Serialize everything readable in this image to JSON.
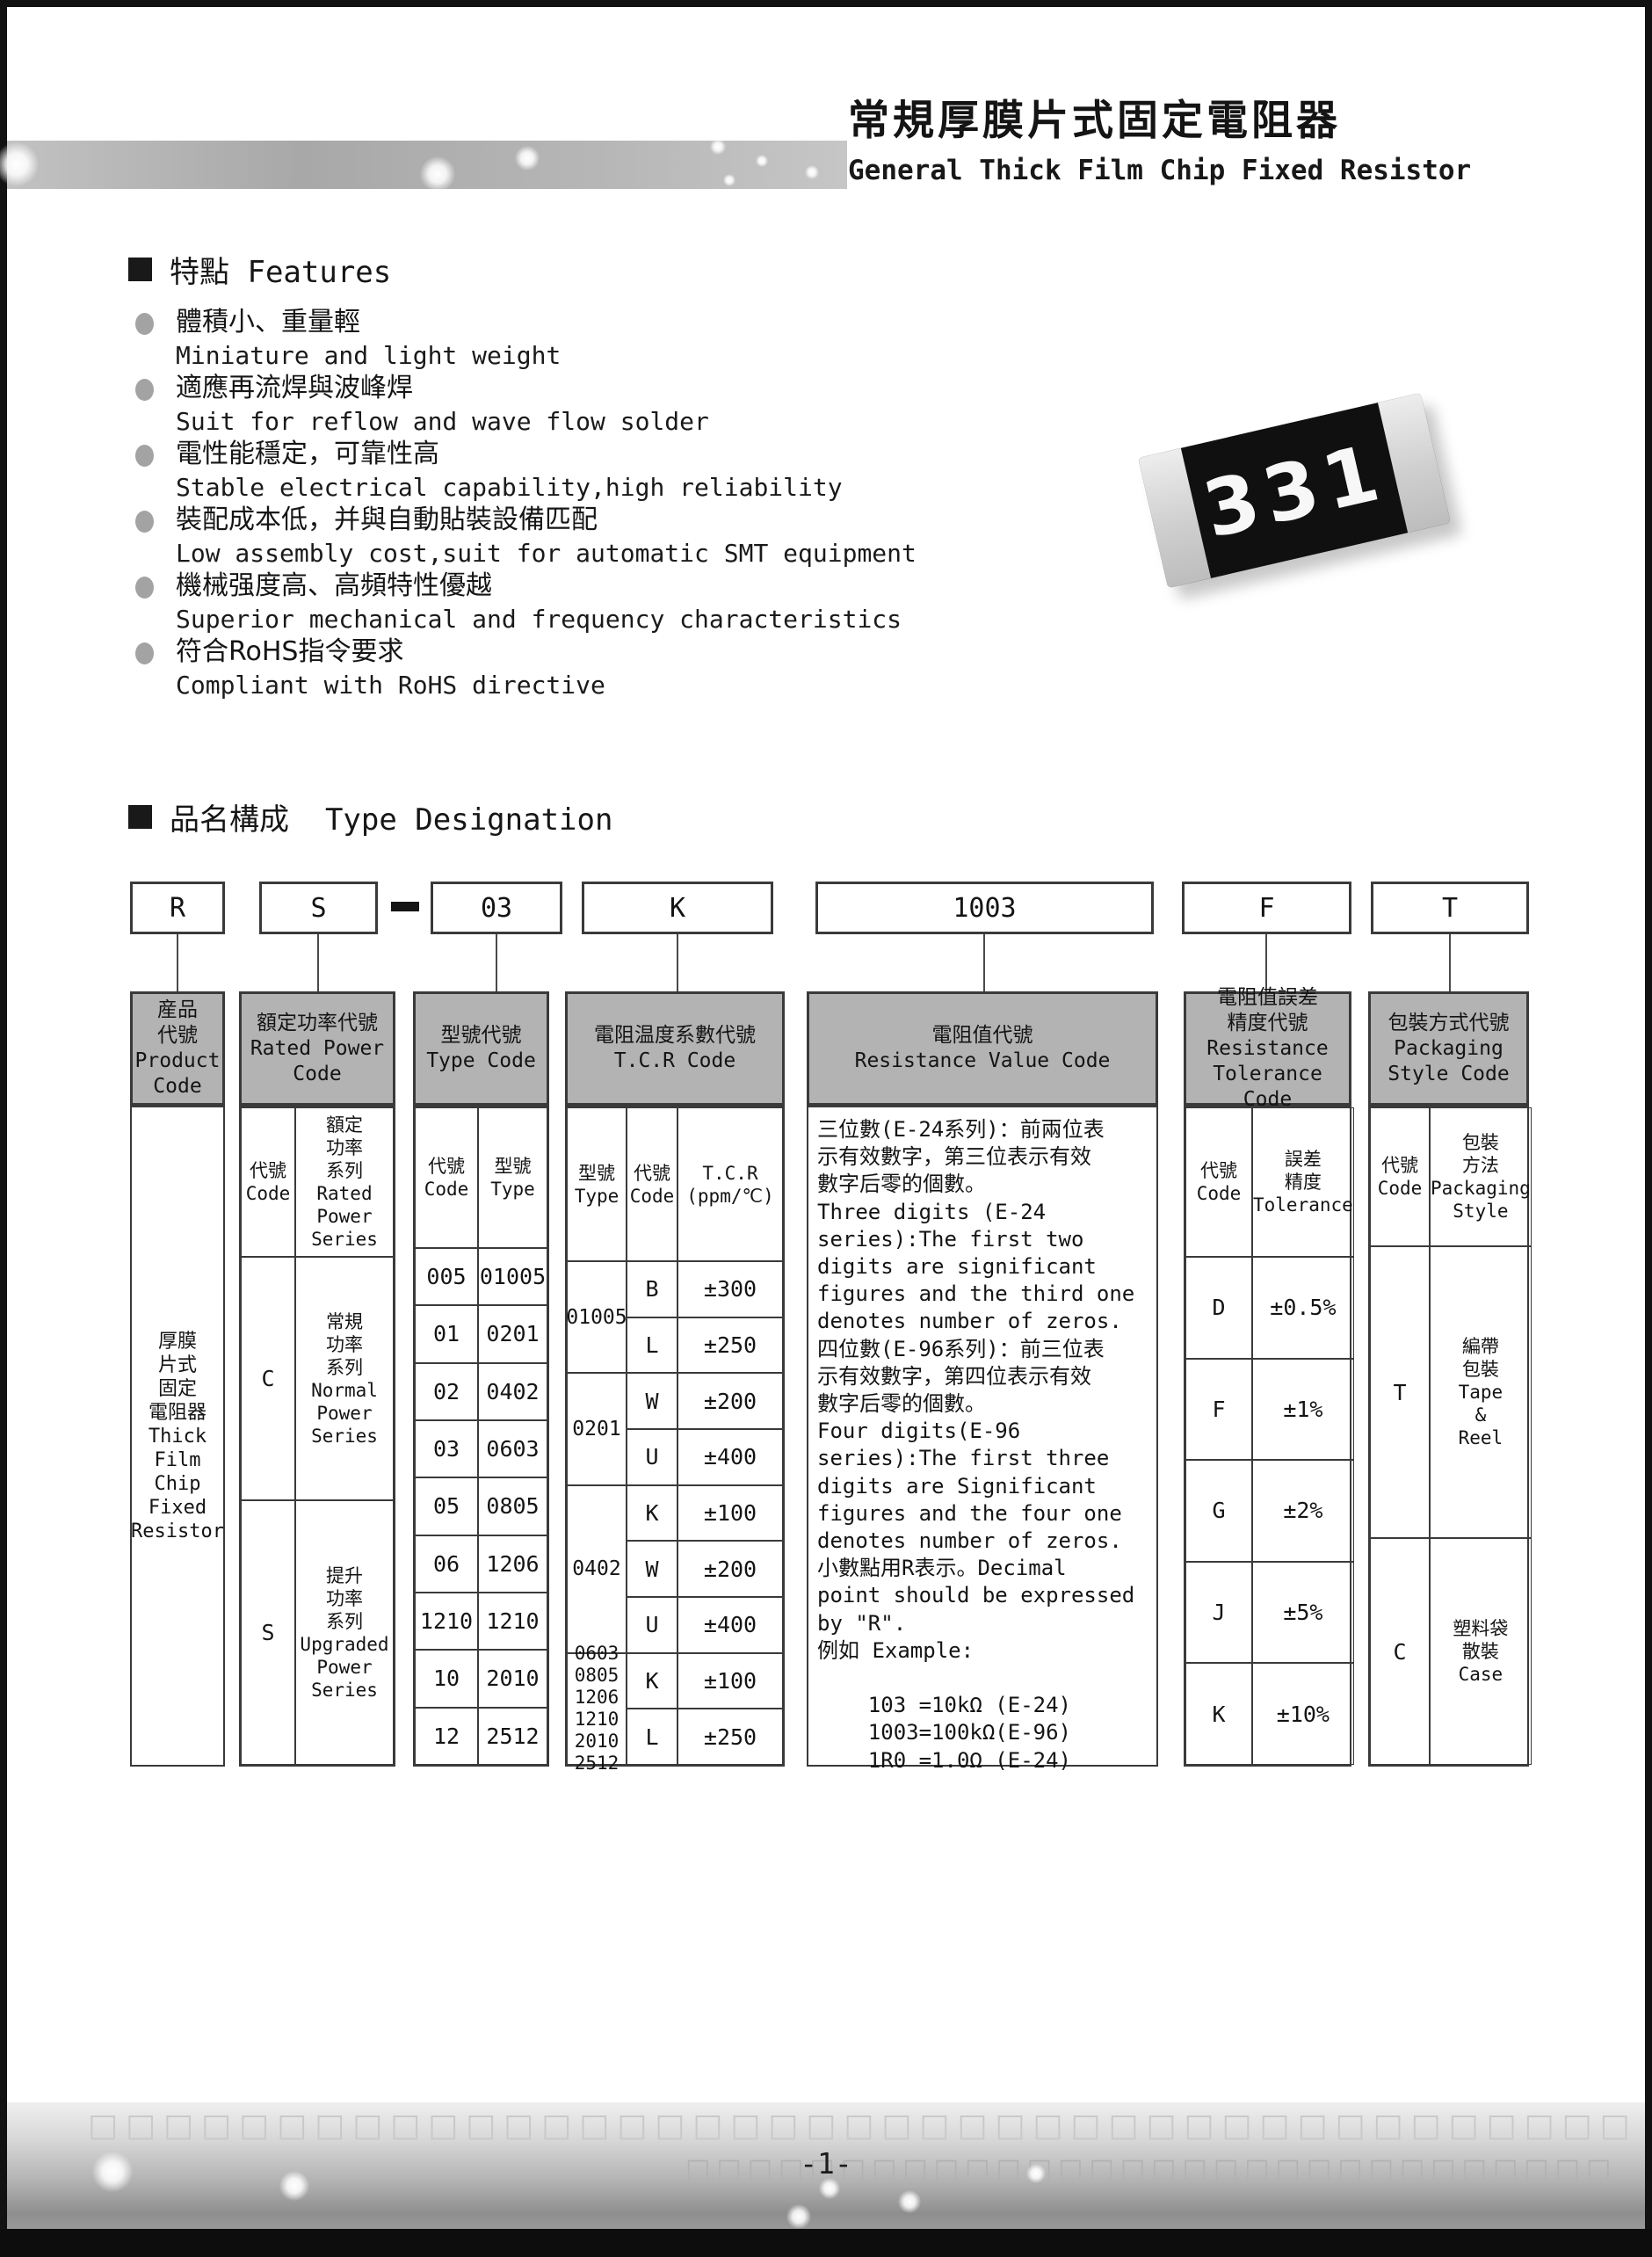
{
  "header": {
    "title_zh": "常規厚膜片式固定電阻器",
    "title_en": "General Thick Film Chip Fixed Resistor"
  },
  "chip": {
    "marking": "331"
  },
  "features": {
    "heading": "特點 Features",
    "items": [
      {
        "zh": "體積小、重量輕",
        "en": "Miniature and light weight"
      },
      {
        "zh": "適應再流焊與波峰焊",
        "en": "Suit for reflow and wave flow solder"
      },
      {
        "zh": "電性能穩定，可靠性高",
        "en": "Stable electrical capability,high reliability"
      },
      {
        "zh": "裝配成本低，并與自動貼裝設備匹配",
        "en": "Low assembly cost,suit for automatic SMT equipment"
      },
      {
        "zh": "機械强度高、高頻特性優越",
        "en": "Superior mechanical and frequency characteristics"
      },
      {
        "zh": "符合RoHS指令要求",
        "en": "Compliant with RoHS directive"
      }
    ]
  },
  "designation": {
    "heading": "品名構成  Type Designation",
    "codes": [
      "R",
      "S",
      "03",
      "K",
      "1003",
      "F",
      "T"
    ]
  },
  "table": {
    "product": {
      "header": "産品\n代號\nProduct\nCode",
      "body": "厚膜\n片式\n固定\n電阻器\nThick\nFilm\nChip\nFixed\nResistor"
    },
    "power": {
      "header": "額定功率代號\nRated Power\nCode",
      "sub_code": "代號\nCode",
      "sub_series": "額定\n功率\n系列\nRated\nPower\nSeries",
      "rows": [
        {
          "code": "C",
          "series": "常規\n功率\n系列\nNormal\nPower\nSeries"
        },
        {
          "code": "S",
          "series": "提升\n功率\n系列\nUpgraded\nPower\nSeries"
        }
      ]
    },
    "type": {
      "header": "型號代號\nType Code",
      "sub_code": "代號\nCode",
      "sub_type": "型號\nType",
      "rows": [
        [
          "005",
          "01005"
        ],
        [
          "01",
          "0201"
        ],
        [
          "02",
          "0402"
        ],
        [
          "03",
          "0603"
        ],
        [
          "05",
          "0805"
        ],
        [
          "06",
          "1206"
        ],
        [
          "1210",
          "1210"
        ],
        [
          "10",
          "2010"
        ],
        [
          "12",
          "2512"
        ]
      ]
    },
    "tcr": {
      "header": "電阻温度系數代號\nT.C.R Code",
      "sub_type": "型號\nType",
      "sub_code": "代號\nCode",
      "sub_val": "T.C.R\n(ppm/℃)",
      "types": [
        "01005",
        "0201",
        "0402",
        "0603\n0805\n1206\n1210\n2010\n2512"
      ],
      "rows": [
        [
          "B",
          "±300"
        ],
        [
          "L",
          "±250"
        ],
        [
          "W",
          "±200"
        ],
        [
          "U",
          "±400"
        ],
        [
          "K",
          "±100"
        ],
        [
          "W",
          "±200"
        ],
        [
          "U",
          "±400"
        ],
        [
          "K",
          "±100"
        ],
        [
          "L",
          "±250"
        ]
      ]
    },
    "resistance": {
      "header": "電阻值代號\nResistance Value Code",
      "body": "三位數(E-24系列)：前兩位表\n示有效數字，第三位表示有效\n數字后零的個數。\nThree digits (E-24\nseries):The first two\ndigits are significant\nfigures and the third one\ndenotes number of zeros.\n四位數(E-96系列)：前三位表\n示有效數字，第四位表示有效\n數字后零的個數。\nFour digits(E-96\nseries):The first three\ndigits are Significant\nfigures and the four one\ndenotes number of zeros.\n小數點用R表示。Decimal\npoint should be expressed\nby \"R\".\n例如 Example:\n\n    103 =10kΩ (E-24)\n    1003=100kΩ(E-96)\n    1R0 =1.0Ω (E-24)"
    },
    "tolerance": {
      "header": "電阻值誤差\n精度代號\nResistance\nTolerance Code",
      "sub_code": "代號\nCode",
      "sub_tol": "誤差\n精度\nTolerance",
      "rows": [
        [
          "D",
          "±0.5%"
        ],
        [
          "F",
          "±1%"
        ],
        [
          "G",
          "±2%"
        ],
        [
          "J",
          "±5%"
        ],
        [
          "K",
          "±10%"
        ]
      ]
    },
    "packaging": {
      "header": "包裝方式代號\nPackaging\nStyle Code",
      "sub_code": "代號\nCode",
      "sub_style": "包裝\n方法\nPackaging\nStyle",
      "rows": [
        {
          "code": "T",
          "style": "編帶\n包裝\nTape\n&\nReel"
        },
        {
          "code": "C",
          "style": "塑料袋\n散裝\nCase"
        }
      ]
    }
  },
  "footer": {
    "page": "-1-"
  }
}
